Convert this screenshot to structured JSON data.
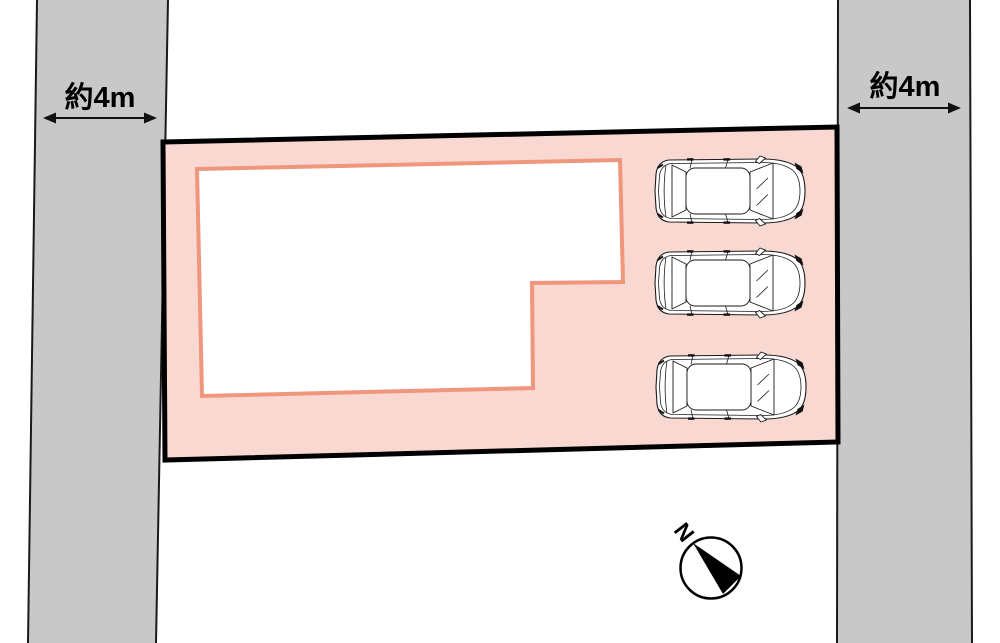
{
  "page": {
    "kind": "site-plan-diagram",
    "width_px": 1000,
    "height_px": 643
  },
  "roads": {
    "left": {
      "width_label": "約4m"
    },
    "right": {
      "width_label": "約4m"
    }
  },
  "site": {
    "cars_parked": 3
  },
  "compass": {
    "north_label": "N"
  },
  "colors": {
    "road_fill": "#c8c8c8",
    "road_edge": "#1a1a1a",
    "plot_fill": "#f9d8d2",
    "plot_border": "#000000",
    "building_fill": "#ffffff",
    "building_outline": "#ef967c",
    "car_line": "#1a1a1a",
    "dim_text": "#000000",
    "compass_color": "#000000"
  }
}
